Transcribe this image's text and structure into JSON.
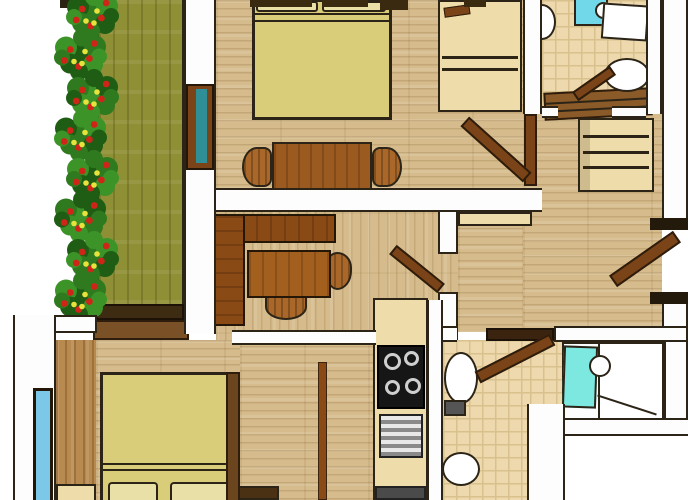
{
  "scene": {
    "type": "floor-plan",
    "style": "hand-drawn color sketch, top-down apartment plan",
    "canvas_px": [
      700,
      500
    ],
    "background": "#ffffff"
  },
  "colors": {
    "outline": "#2b2417",
    "wall_white": "#fdfdfd",
    "wood_light": "#d6bc8d",
    "wood_medium": "#b98a50",
    "olive_floor": "#8f8f36",
    "dark_edge": "#3e2c12",
    "duvet_yellow": "#d9cd7a",
    "pillow_cream": "#e9e0a8",
    "furniture_brown": "#9a5a20",
    "desk_brown": "#8a4a16",
    "door_brown": "#7a4418",
    "cabinet_cream": "#eedcab",
    "tile_beige": "#eed9ae",
    "tile_line": "#d8c18c",
    "cooktop_black": "#161616",
    "steel_gray": "#b9b9b9",
    "window_cyan": "#70d8e8",
    "vanity_cyan": "#7ce8e0",
    "window_teal": "#2f8f96",
    "leaf_green": "#2f7a1f",
    "leaf_dark": "#1f5c14",
    "leaf_mid": "#3c9428",
    "berry_red": "#cf2518",
    "flower_yellow": "#e8e33c",
    "fixture_white": "#ffffff",
    "tank_gray": "#555555"
  },
  "balcony": {
    "bush_clusters": 8
  },
  "rooms": [
    {
      "name": "balcony",
      "floor": "olive wood deck",
      "features": [
        "flowering hedge",
        "railing"
      ]
    },
    {
      "name": "studio bedroom",
      "floor": "light wood",
      "features": [
        "double bed",
        "two pillows",
        "dining table",
        "two dining chairs",
        "wardrobe",
        "balcony window"
      ]
    },
    {
      "name": "top bathroom",
      "floor": "beige tile",
      "features": [
        "washbasin",
        "vanity counter",
        "toilet",
        "door"
      ]
    },
    {
      "name": "hallway",
      "floor": "light wood",
      "features": [
        "wooden bench",
        "chest of drawers",
        "entry door"
      ]
    },
    {
      "name": "office",
      "floor": "light wood",
      "features": [
        "l-shaped desk",
        "inner desk",
        "office chair",
        "side chair",
        "door to hallway"
      ]
    },
    {
      "name": "kitchen",
      "floor": "light wood",
      "features": [
        "counter strip",
        "cooktop with 4 burners",
        "dishwasher",
        "support column"
      ]
    },
    {
      "name": "lower bedroom",
      "floor": "light wood",
      "features": [
        "double bed",
        "two pillows",
        "nightstands",
        "wall shelf",
        "window"
      ]
    },
    {
      "name": "lower bathroom",
      "floor": "beige tile",
      "features": [
        "toilet",
        "bidet",
        "door"
      ]
    },
    {
      "name": "washbasin nook",
      "floor": "white",
      "features": [
        "glass panel",
        "round basin",
        "counter",
        "window"
      ]
    }
  ]
}
